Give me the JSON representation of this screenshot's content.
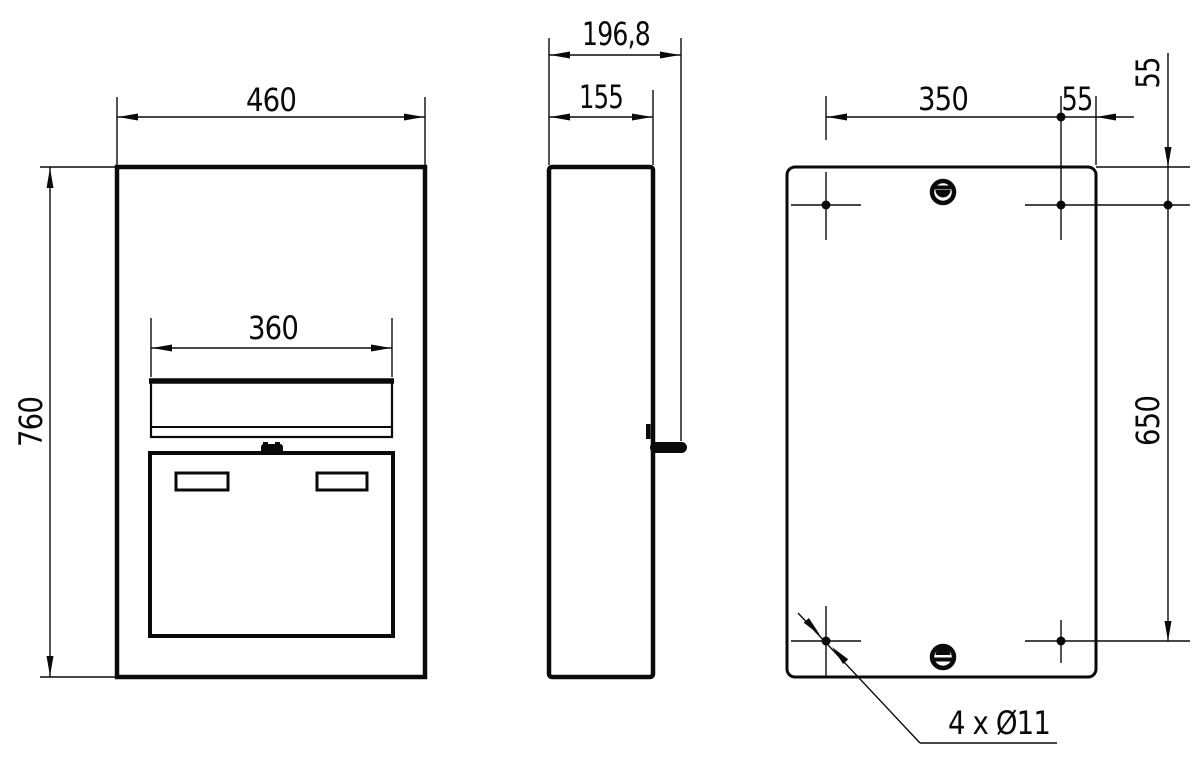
{
  "drawing": {
    "type": "technical-orthographic-drawing",
    "subject": "wall mailbox with letter flap, door and rear mounting holes",
    "views": [
      "front",
      "side",
      "back"
    ],
    "line_color": "#0a0a0a",
    "background_color": "#ffffff"
  },
  "dims": {
    "front_width": "460",
    "front_height": "760",
    "slot_width": "360",
    "depth_total": "196,8",
    "depth_body": "155",
    "hole_spacing_horizontal": "350",
    "hole_offset_right": "55",
    "hole_offset_top": "55",
    "hole_spacing_vertical": "650",
    "hole_callout": "4 x Ø11"
  }
}
